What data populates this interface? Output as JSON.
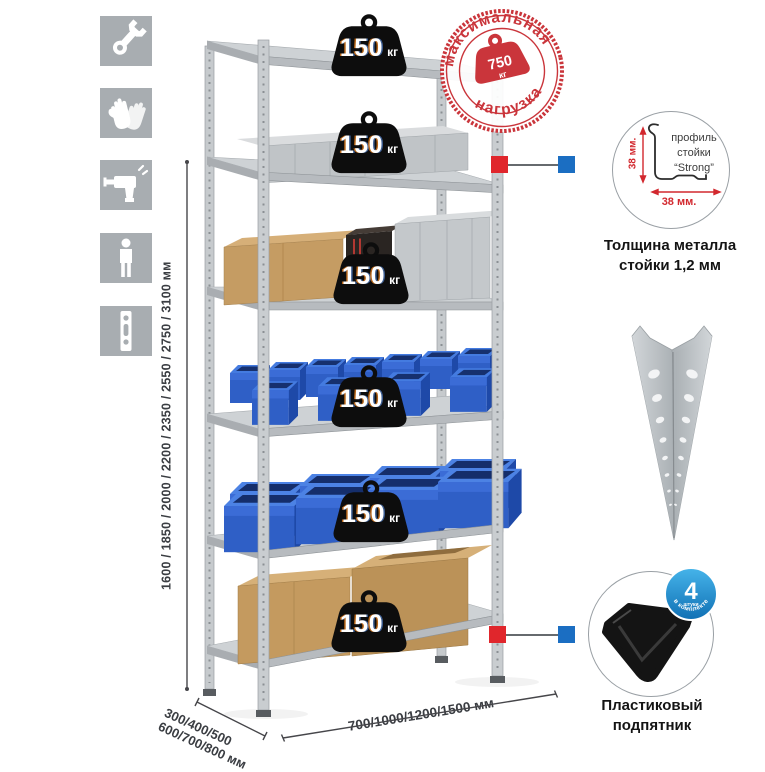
{
  "stamp": {
    "arc_top": "максимальная",
    "arc_bottom": "нагрузка",
    "weight_value": "750",
    "weight_unit": "кг"
  },
  "rack": {
    "shelf_load_value": "150",
    "shelf_load_unit": "кг",
    "shelf_count": 6
  },
  "dimensions": {
    "height": "1600 / 1850 / 2000 / 2200 / 2350 / 2550 / 2750 / 3100 мм",
    "depth_line1": "300/400/500",
    "depth_line2": "600/700/800 мм",
    "width": "700/1000/1200/1500 мм"
  },
  "profile_detail": {
    "line1": "профиль",
    "line2": "стойки",
    "line3": "“Strong”",
    "dim_vertical": "38 мм.",
    "dim_horizontal": "38 мм.",
    "caption1": "Толщина металла",
    "caption2": "стойки 1,2 мм"
  },
  "foot_detail": {
    "badge_value": "4",
    "badge_sub": "штуки",
    "badge_arc": "в комплекте",
    "caption1": "Пластиковый",
    "caption2": "подпятник"
  },
  "icons": [
    {
      "name": "wrench-icon"
    },
    {
      "name": "gloves-icon"
    },
    {
      "name": "drill-icon"
    },
    {
      "name": "person-icon"
    },
    {
      "name": "post-profile-icon"
    }
  ],
  "colors": {
    "stamp_red": "#ca353b",
    "accent_red": "#e0262c",
    "accent_blue": "#1b6ec2",
    "bin_blue": "#2f5fc6",
    "metal": "#c6cacd",
    "cardboard": "#c59c63",
    "icon_gray": "#a8adb1",
    "badge_black": "#0d0d0d",
    "included_badge_blue": "#1f8fd0"
  }
}
